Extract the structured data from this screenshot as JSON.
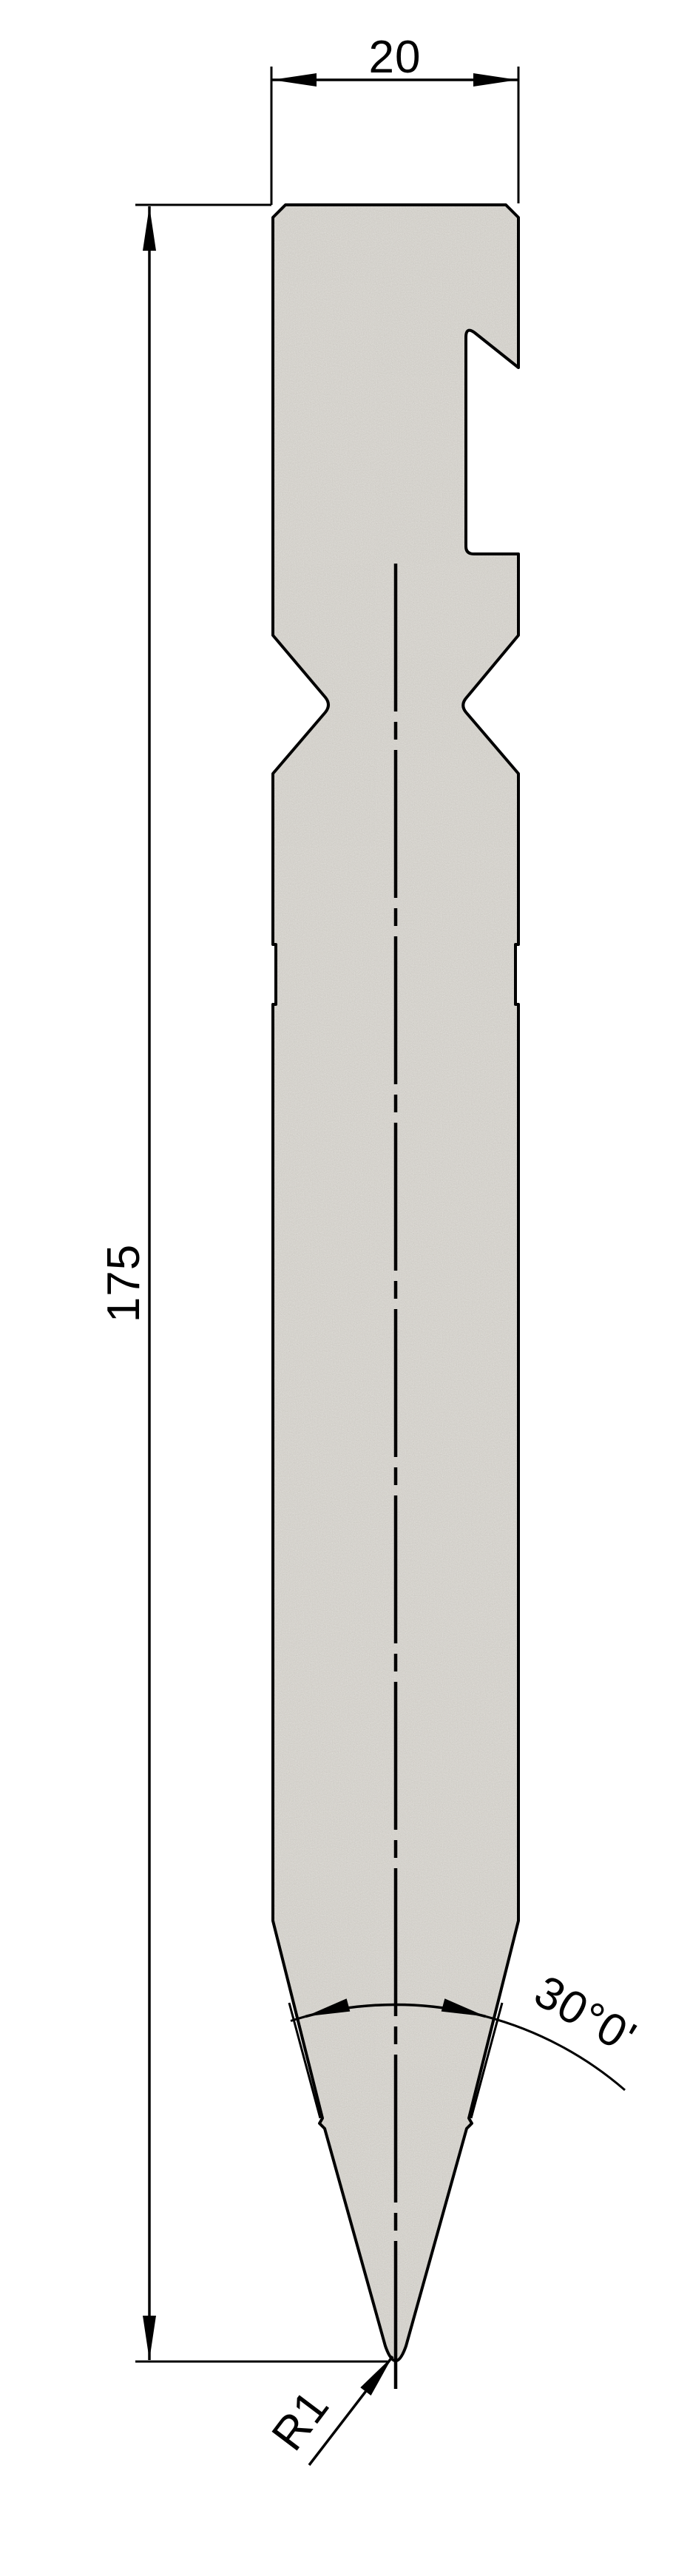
{
  "labels": {
    "width_dimension": "20",
    "height_dimension": "175",
    "tip_angle_dimension": "30°0'",
    "tip_radius_dimension": "R1"
  },
  "colors": {
    "background": "#ffffff",
    "material_fill": "#cdcac4",
    "line_color": "#000000"
  }
}
